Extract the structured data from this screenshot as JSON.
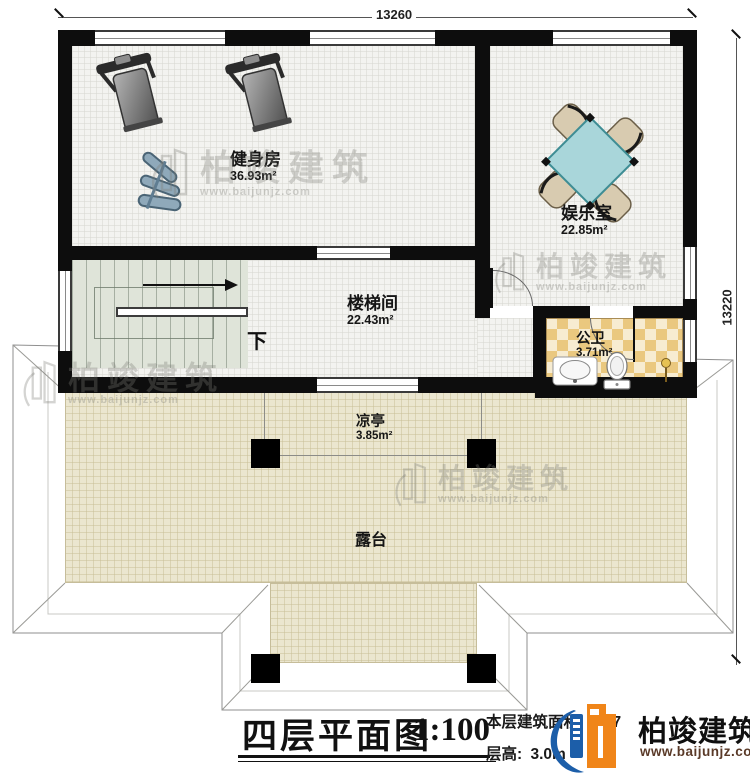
{
  "dimensions": {
    "width_top": "13260",
    "height_right": "13220"
  },
  "rooms": {
    "gym": {
      "name": "健身房",
      "area": "36.93m²"
    },
    "entertainment": {
      "name": "娱乐室",
      "area": "22.85m²"
    },
    "stairwell": {
      "name": "楼梯间",
      "area": "22.43m²"
    },
    "bathroom": {
      "name": "公卫",
      "area": "3.71m²"
    },
    "pavilion": {
      "name": "凉亭",
      "area": "3.85m²"
    },
    "terrace": {
      "name": "露台"
    }
  },
  "stairs": {
    "down_label": "下"
  },
  "title_block": {
    "title": "四层平面图",
    "scale": "1:100",
    "floor_area_label": "本层建筑面积:",
    "floor_area_partial": "7",
    "floor_height_label": "层高:",
    "floor_height_value": "3.0m"
  },
  "brand": {
    "name": "柏竣建筑",
    "website": "www.baijunjz.com"
  },
  "watermark": {
    "name": "柏竣建筑",
    "website": "www.baijunjz.com"
  },
  "icons": {
    "treadmill": "treadmill-top-view",
    "dumbbell_rack": "dumbbell-rack",
    "table_set": "square-table-with-chairs",
    "toilet": "toilet-top-view",
    "sink": "sink-top-view",
    "shower": "shower-head",
    "stair_arrow": "direction-arrow",
    "brand_logo": "building-logo",
    "watermark_logo": "building-logo-outline"
  },
  "colors": {
    "wall": "#0d0d0d",
    "floor_grid": "#f3f3f0",
    "stairs": "#dfe4d9",
    "terrace": "#ebe6cf",
    "bath_tile_dark": "#eac87f",
    "bath_tile_light": "#f7ecd1",
    "table": "#a9d6da",
    "chair": "#d8cbb0",
    "logo_orange": "#f08519",
    "logo_blue": "#1c5ea9",
    "website_text": "#5a3a28"
  }
}
